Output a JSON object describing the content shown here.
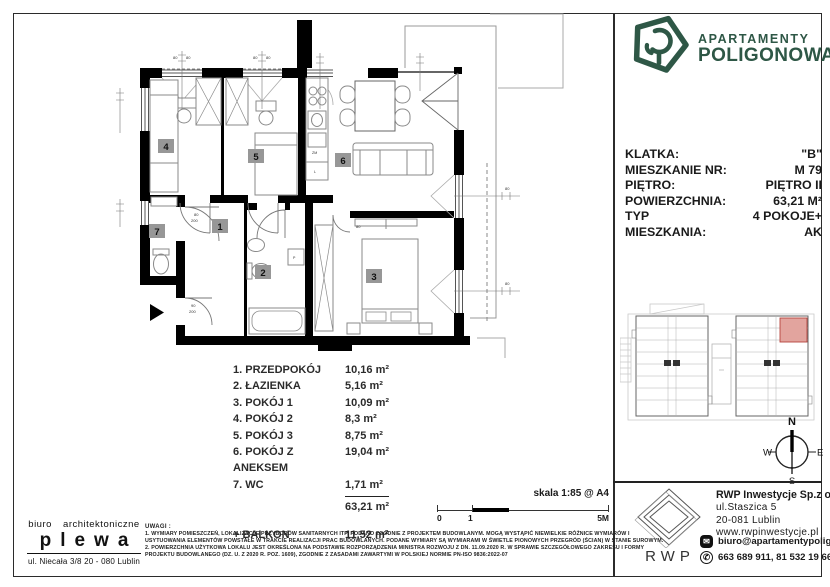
{
  "brand": {
    "line1": "APARTAMENTY",
    "line2": "POLIGONOWA",
    "color": "#2e5746"
  },
  "details": {
    "rows": [
      {
        "label": "KLATKA:",
        "value": "\"B\""
      },
      {
        "label": "MIESZKANIE NR:",
        "value": "M  79"
      },
      {
        "label": "PIĘTRO:",
        "value": "PIĘTRO II"
      },
      {
        "label": "POWIERZCHNIA:",
        "value": "63,21 M²"
      },
      {
        "label": "TYP MIESZKANIA:",
        "value": "4 POKOJE+ AK"
      }
    ]
  },
  "plan": {
    "badges": [
      "1",
      "2",
      "3",
      "4",
      "5",
      "6",
      "7"
    ],
    "dims": {
      "win": "80",
      "door_w": "80",
      "door_h": "200",
      "ent_w": "90"
    },
    "labels": {
      "dishwasher": "ZM",
      "fridge": "L",
      "washer": "P"
    }
  },
  "room_list": {
    "items": [
      {
        "name": "1. PRZEDPOKÓJ",
        "area": "10,16 m²"
      },
      {
        "name": "2. ŁAZIENKA",
        "area": "5,16 m²"
      },
      {
        "name": "3. POKÓJ 1",
        "area": "10,09 m²"
      },
      {
        "name": "4. POKÓJ 2",
        "area": "8,3 m²"
      },
      {
        "name": "5. POKÓJ 3",
        "area": "8,75 m²"
      },
      {
        "name": "6. POKÓJ Z ANEKSEM",
        "area": "19,04 m²"
      },
      {
        "name": "7. WC",
        "area": "1,71 m²"
      }
    ],
    "total": "63,21 m²",
    "balcony_label": "+ BALKON",
    "balcony_area": "11,52 m²"
  },
  "scale": {
    "label": "skala 1:85 @ A4",
    "tick0": "0",
    "tick1": "1",
    "tick5": "5M"
  },
  "notes": {
    "title": "UWAGI :",
    "lines": [
      "1. WYMIARY POMIESZCZEŃ, LOKALIZACJE PRZYBORÓW SANITARNYCH ITP. PODANO ZGODNIE Z PROJEKTEM BUDOWLANYM. MOGĄ WYSTĄPIĆ NIEWIELKIE RÓŻNICE WYMIARÓW I",
      "USYTUOWANIA ELEMENTÓW POWSTAŁE W TRAKCIE REALIZACJI PRAC BUDOWLANYCH. PODANE WYMIARY SĄ WYMIARAMI W ŚWIETLE PIONOWYCH PRZEGRÓD (ŚCIAN) W STANIE SUROWYM.",
      "2. POWIERZCHNIA UŻYTKOWA LOKALU JEST OKREŚLONA NA PODSTAWIE ROZPORZĄDZENIA MINISTRA ROZWOJU Z DN. 11.09.2020 R. W SPRAWIE SZCZEGÓŁOWEGO ZAKRESU I FORMY",
      "PROJEKTU BUDOWLANEGO (DZ. U. Z 2020 R. POZ. 1609), ZGODNIE Z ZASADAMI ZAWARTYMI W POLSKIEJ NORMIE PN-ISO 9836:2022-07"
    ]
  },
  "architect": {
    "line1": "biuro architektoniczne",
    "name": "plewa",
    "address": "ul. Niecała 3/8  20 - 080 Lublin"
  },
  "compass": {
    "n": "N",
    "s": "S",
    "e": "E",
    "w": "W"
  },
  "developer": {
    "logo_text": "RWP",
    "company": "RWP Inwestycje Sp.z o.o.",
    "address1": "ul.Staszica 5",
    "address2": "20-081 Lublin",
    "website": "www.rwpinwestycje.pl",
    "email": "biuro@apartamentypoligonowa.pl",
    "phones": "663 689 911,  81 532 19 66"
  },
  "site_plan": {
    "highlight_color": "#e2a49e"
  }
}
